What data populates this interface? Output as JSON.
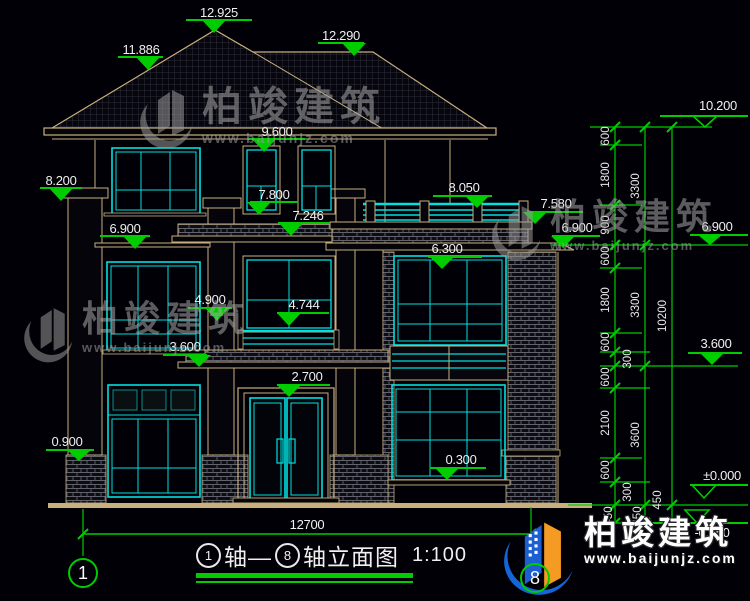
{
  "drawing": {
    "title_axis_left": "1",
    "title_mid": "轴—",
    "title_axis_right": "8",
    "title_tail": "轴立面图",
    "scale_label": "1:100",
    "bottom_dim": "12700",
    "axis_left_bubble": "1",
    "axis_right_bubble": "8"
  },
  "watermark": {
    "brand": "柏竣建筑",
    "url": "www.baijunjz.com"
  },
  "colors": {
    "background": "#000006",
    "line_tan": "#C8B07E",
    "glass_cyan": "#00E0E0",
    "dim_green": "#00CC00",
    "text_white": "#F0F0F0",
    "logo_blue": "#1565D8",
    "logo_orange": "#F59A23"
  },
  "markers": [
    {
      "t": "12.925",
      "tx": 219,
      "ty": 17,
      "l": [
        186,
        252,
        20
      ],
      "tri": [
        214,
        20,
        33
      ],
      "f": 1
    },
    {
      "t": "11.886",
      "tx": 141,
      "ty": 54,
      "l": [
        118,
        163,
        57
      ],
      "tri": [
        148,
        57,
        70
      ],
      "f": 1
    },
    {
      "t": "12.290",
      "tx": 341,
      "ty": 40,
      "l": [
        318,
        364,
        43
      ],
      "tri": [
        354,
        43,
        56
      ],
      "f": 1
    },
    {
      "t": "9.600",
      "tx": 277,
      "ty": 136,
      "l": [
        248,
        305,
        139
      ],
      "tri": [
        264,
        139,
        152
      ],
      "f": 1
    },
    {
      "t": "8.200",
      "tx": 61,
      "ty": 185,
      "l": [
        40,
        82,
        188
      ],
      "tri": [
        61,
        188,
        201
      ],
      "f": 1
    },
    {
      "t": "6.900",
      "tx": 125,
      "ty": 233,
      "l": [
        100,
        150,
        236
      ],
      "tri": [
        135,
        236,
        249
      ],
      "f": 1
    },
    {
      "t": "7.800",
      "tx": 274,
      "ty": 199,
      "l": [
        250,
        298,
        202
      ],
      "tri": [
        259,
        202,
        215
      ],
      "f": 1
    },
    {
      "t": "7.246",
      "tx": 308,
      "ty": 220,
      "l": [
        278,
        330,
        223
      ],
      "tri": [
        291,
        223,
        236
      ],
      "f": 1
    },
    {
      "t": "8.050",
      "tx": 464,
      "ty": 192,
      "l": [
        433,
        492,
        196
      ],
      "tri": [
        477,
        196,
        208
      ],
      "f": 1
    },
    {
      "t": "7.580",
      "tx": 556,
      "ty": 208,
      "l": [
        527,
        583,
        212
      ],
      "tri": [
        535,
        212,
        224
      ],
      "f": 1
    },
    {
      "t": "6.900",
      "tx": 577,
      "ty": 232,
      "l": [
        552,
        600,
        236
      ],
      "tri": [
        563,
        236,
        248
      ],
      "f": 1
    },
    {
      "t": "6.300",
      "tx": 447,
      "ty": 253,
      "l": [
        428,
        482,
        257
      ],
      "tri": [
        442,
        257,
        269
      ],
      "f": 1
    },
    {
      "t": "4.900",
      "tx": 210,
      "ty": 304,
      "l": [
        188,
        232,
        308
      ],
      "tri": [
        217,
        308,
        321
      ],
      "f": 1
    },
    {
      "t": "4.744",
      "tx": 304,
      "ty": 309,
      "l": [
        277,
        329,
        313
      ],
      "tri": [
        289,
        313,
        326
      ],
      "f": 1
    },
    {
      "t": "3.600",
      "tx": 185,
      "ty": 351,
      "l": [
        163,
        207,
        355
      ],
      "tri": [
        199,
        355,
        367
      ],
      "f": 1
    },
    {
      "t": "2.700",
      "tx": 307,
      "ty": 381,
      "l": [
        277,
        330,
        385
      ],
      "tri": [
        289,
        385,
        397
      ],
      "f": 1
    },
    {
      "t": "0.900",
      "tx": 67,
      "ty": 446,
      "l": [
        46,
        94,
        450
      ],
      "tri": [
        79,
        450,
        461
      ],
      "f": 1
    },
    {
      "t": "0.300",
      "tx": 461,
      "ty": 464,
      "l": [
        430,
        486,
        468
      ],
      "tri": [
        447,
        468,
        480
      ],
      "f": 1
    },
    {
      "t": "10.200",
      "tx": 718,
      "ty": 110,
      "l": [
        660,
        748,
        116
      ],
      "tri": [
        705,
        116,
        127
      ],
      "f": 0
    },
    {
      "t": "6.900",
      "tx": 717,
      "ty": 231,
      "l": [
        690,
        748,
        235
      ],
      "tri": [
        710,
        235,
        245
      ],
      "f": 1
    },
    {
      "t": "3.600",
      "tx": 716,
      "ty": 348,
      "l": [
        688,
        742,
        353
      ],
      "tri": [
        712,
        353,
        365
      ],
      "f": 1
    },
    {
      "t": "±0.000",
      "tx": 722,
      "ty": 480,
      "l": [
        690,
        748,
        485
      ],
      "tri": [
        704,
        485,
        498
      ],
      "f": 0
    },
    {
      "t": "-0.450",
      "tx": 712,
      "ty": 537,
      "l": [
        640,
        748,
        523
      ],
      "tri": [
        697,
        510,
        523
      ],
      "f": 0
    }
  ],
  "chain": {
    "lines_x": [
      615,
      645,
      672
    ],
    "line_y": [
      127,
      523
    ],
    "tick_levels": [
      [
        127,
        145,
        205,
        245,
        268,
        333,
        352,
        366,
        388,
        458,
        482,
        505,
        523
      ],
      [
        127,
        245,
        366,
        505,
        523
      ],
      [
        127,
        505,
        523
      ]
    ],
    "level_lines": [
      [
        590,
        712,
        127
      ],
      [
        600,
        642,
        145
      ],
      [
        600,
        642,
        205
      ],
      [
        552,
        748,
        245
      ],
      [
        600,
        642,
        268
      ],
      [
        600,
        642,
        333
      ],
      [
        600,
        650,
        352
      ],
      [
        600,
        738,
        366
      ],
      [
        600,
        650,
        388
      ],
      [
        600,
        642,
        458
      ],
      [
        600,
        650,
        482
      ],
      [
        568,
        748,
        505
      ],
      [
        608,
        748,
        523
      ]
    ],
    "labels": [
      {
        "t": "600",
        "x": 609,
        "y": 136
      },
      {
        "t": "1800",
        "x": 609,
        "y": 175
      },
      {
        "t": "900",
        "x": 609,
        "y": 225
      },
      {
        "t": "600",
        "x": 609,
        "y": 256
      },
      {
        "t": "1800",
        "x": 609,
        "y": 300
      },
      {
        "t": "600",
        "x": 609,
        "y": 342
      },
      {
        "t": "300",
        "x": 631,
        "y": 359
      },
      {
        "t": "600",
        "x": 609,
        "y": 377
      },
      {
        "t": "2100",
        "x": 609,
        "y": 423
      },
      {
        "t": "600",
        "x": 609,
        "y": 470
      },
      {
        "t": "300",
        "x": 631,
        "y": 492
      },
      {
        "t": "450",
        "x": 612,
        "y": 516
      },
      {
        "t": "3300",
        "x": 639,
        "y": 186
      },
      {
        "t": "3300",
        "x": 639,
        "y": 305
      },
      {
        "t": "3600",
        "x": 639,
        "y": 435
      },
      {
        "t": "450",
        "x": 641,
        "y": 516
      },
      {
        "t": "10200",
        "x": 666,
        "y": 316
      },
      {
        "t": "450",
        "x": 661,
        "y": 500
      }
    ]
  }
}
